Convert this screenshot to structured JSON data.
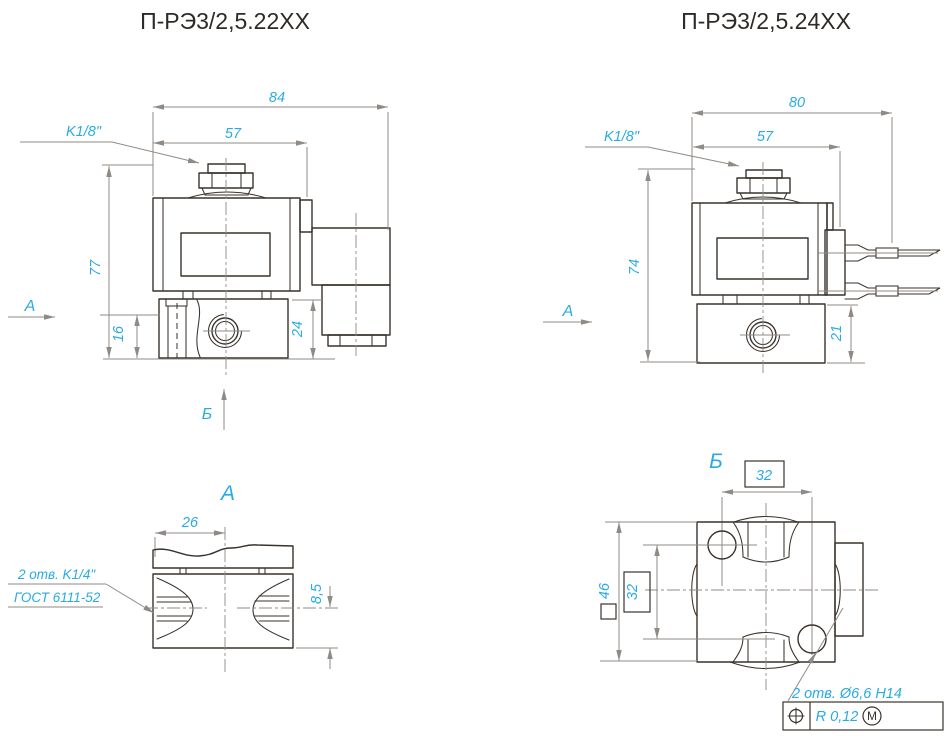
{
  "colors": {
    "accent": "#29abe2",
    "outline": "#3a322c",
    "dim_line": "#8f8a85"
  },
  "left_view": {
    "title": "П-РЭ3/2,5.22ХХ",
    "thread_label": "K1/8\"",
    "dim_overall_width": "84",
    "dim_coil_width": "57",
    "dim_overall_height": "77",
    "dim_port_axis_height": "16",
    "dim_body_height": "24",
    "arrow_a_label": "A",
    "arrow_b_label": "Б"
  },
  "right_view": {
    "title": "П-РЭ3/2,5.24ХХ",
    "thread_label": "K1/8\"",
    "dim_overall_width": "80",
    "dim_coil_width": "57",
    "dim_overall_height": "74",
    "dim_body_height": "21",
    "arrow_a_label": "A"
  },
  "view_a": {
    "title": "A",
    "dim_port_offset": "26",
    "dim_axis_height": "8,5",
    "note_line1": "2 отв. K1/4\"",
    "note_line2": "ГОСТ 6111-52"
  },
  "view_b": {
    "title": "Б",
    "dim_hole_spacing_h": "32",
    "dim_hole_spacing_v": "32",
    "dim_body_square": "46",
    "note_holes": "2 отв. Ø6,6 H14",
    "tol_value": "R 0,12",
    "tol_modifier": "M"
  }
}
